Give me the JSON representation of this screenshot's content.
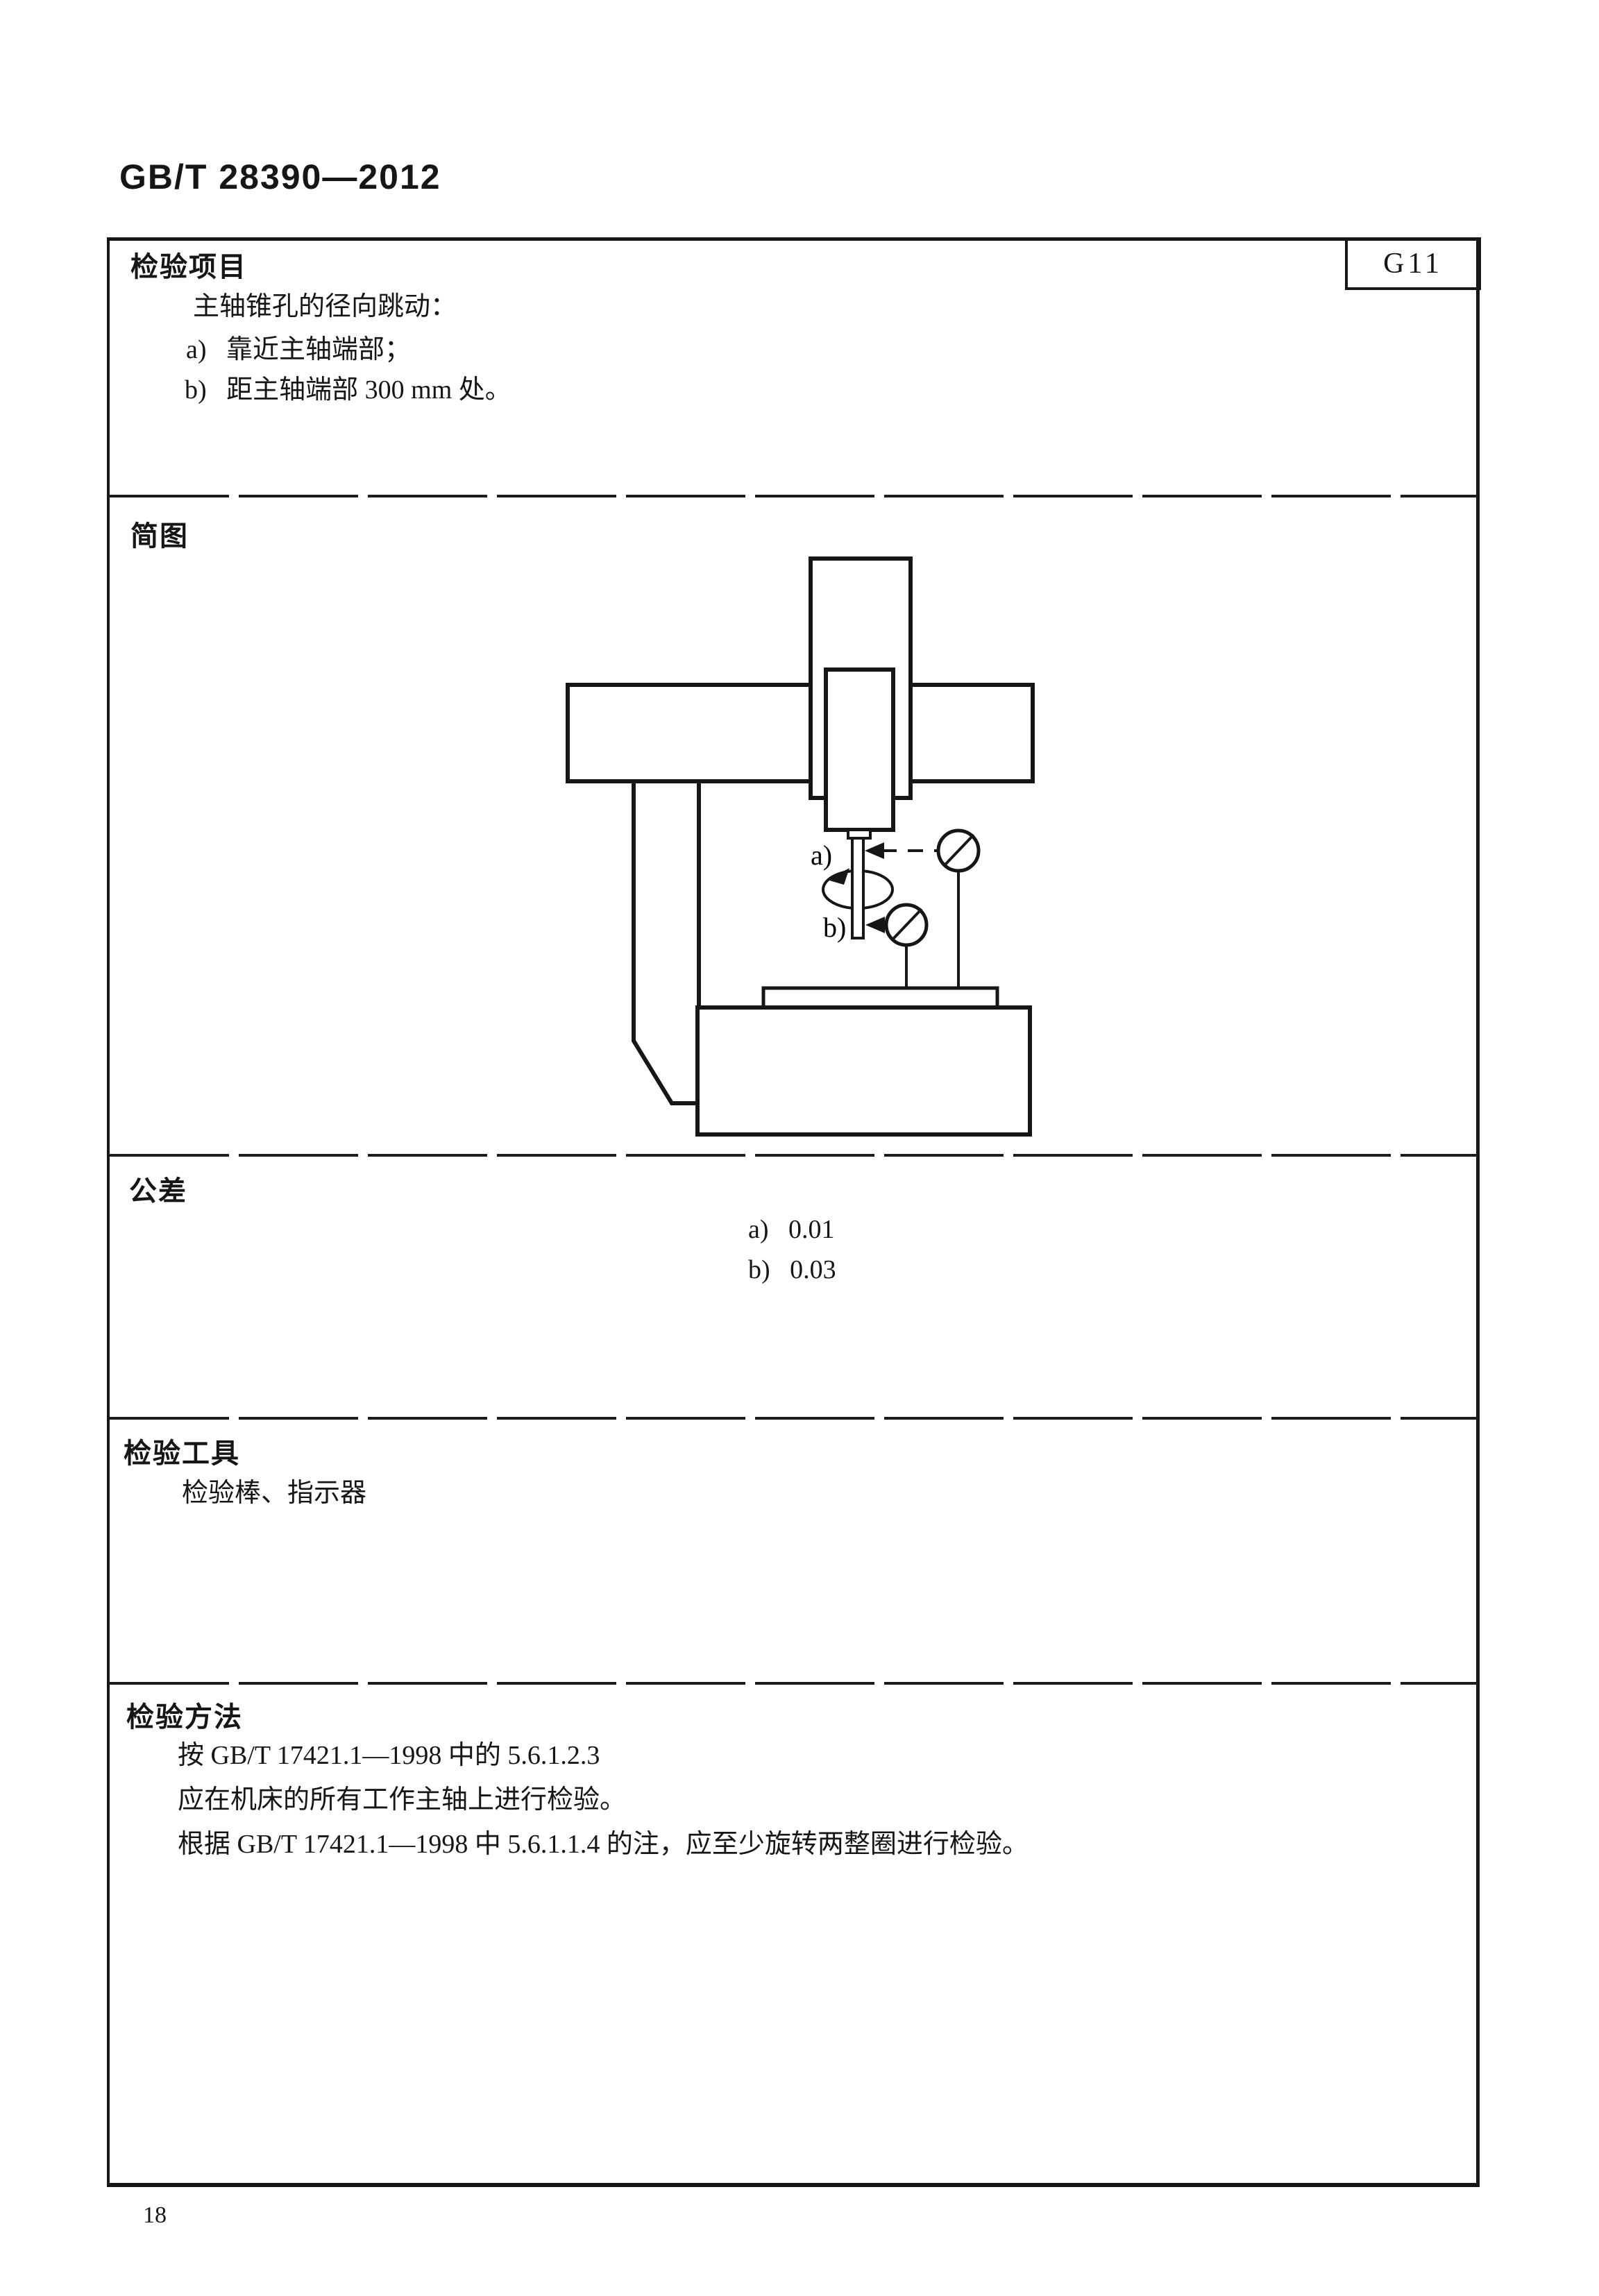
{
  "page": {
    "header": "GB/T 28390—2012",
    "page_number": "18"
  },
  "table": {
    "code": "G11",
    "sections": {
      "item": {
        "label": "检验项目",
        "intro": "主轴锥孔的径向跳动：",
        "item_a": "a)   靠近主轴端部；",
        "item_b": "b)   距主轴端部 300 mm 处。"
      },
      "diagram": {
        "label": "简图",
        "callout_a": "a)",
        "callout_b": "b)"
      },
      "tolerance": {
        "label": "公差",
        "value_a": "a)   0.01",
        "value_b": "b)   0.03"
      },
      "tools": {
        "label": "检验工具",
        "content": "检验棒、指示器"
      },
      "method": {
        "label": "检验方法",
        "line1": "按 GB/T 17421.1—1998 中的 5.6.1.2.3",
        "line2": "应在机床的所有工作主轴上进行检验。",
        "line3": "根据 GB/T 17421.1—1998 中 5.6.1.1.4 的注，应至少旋转两整圈进行检验。"
      }
    }
  }
}
